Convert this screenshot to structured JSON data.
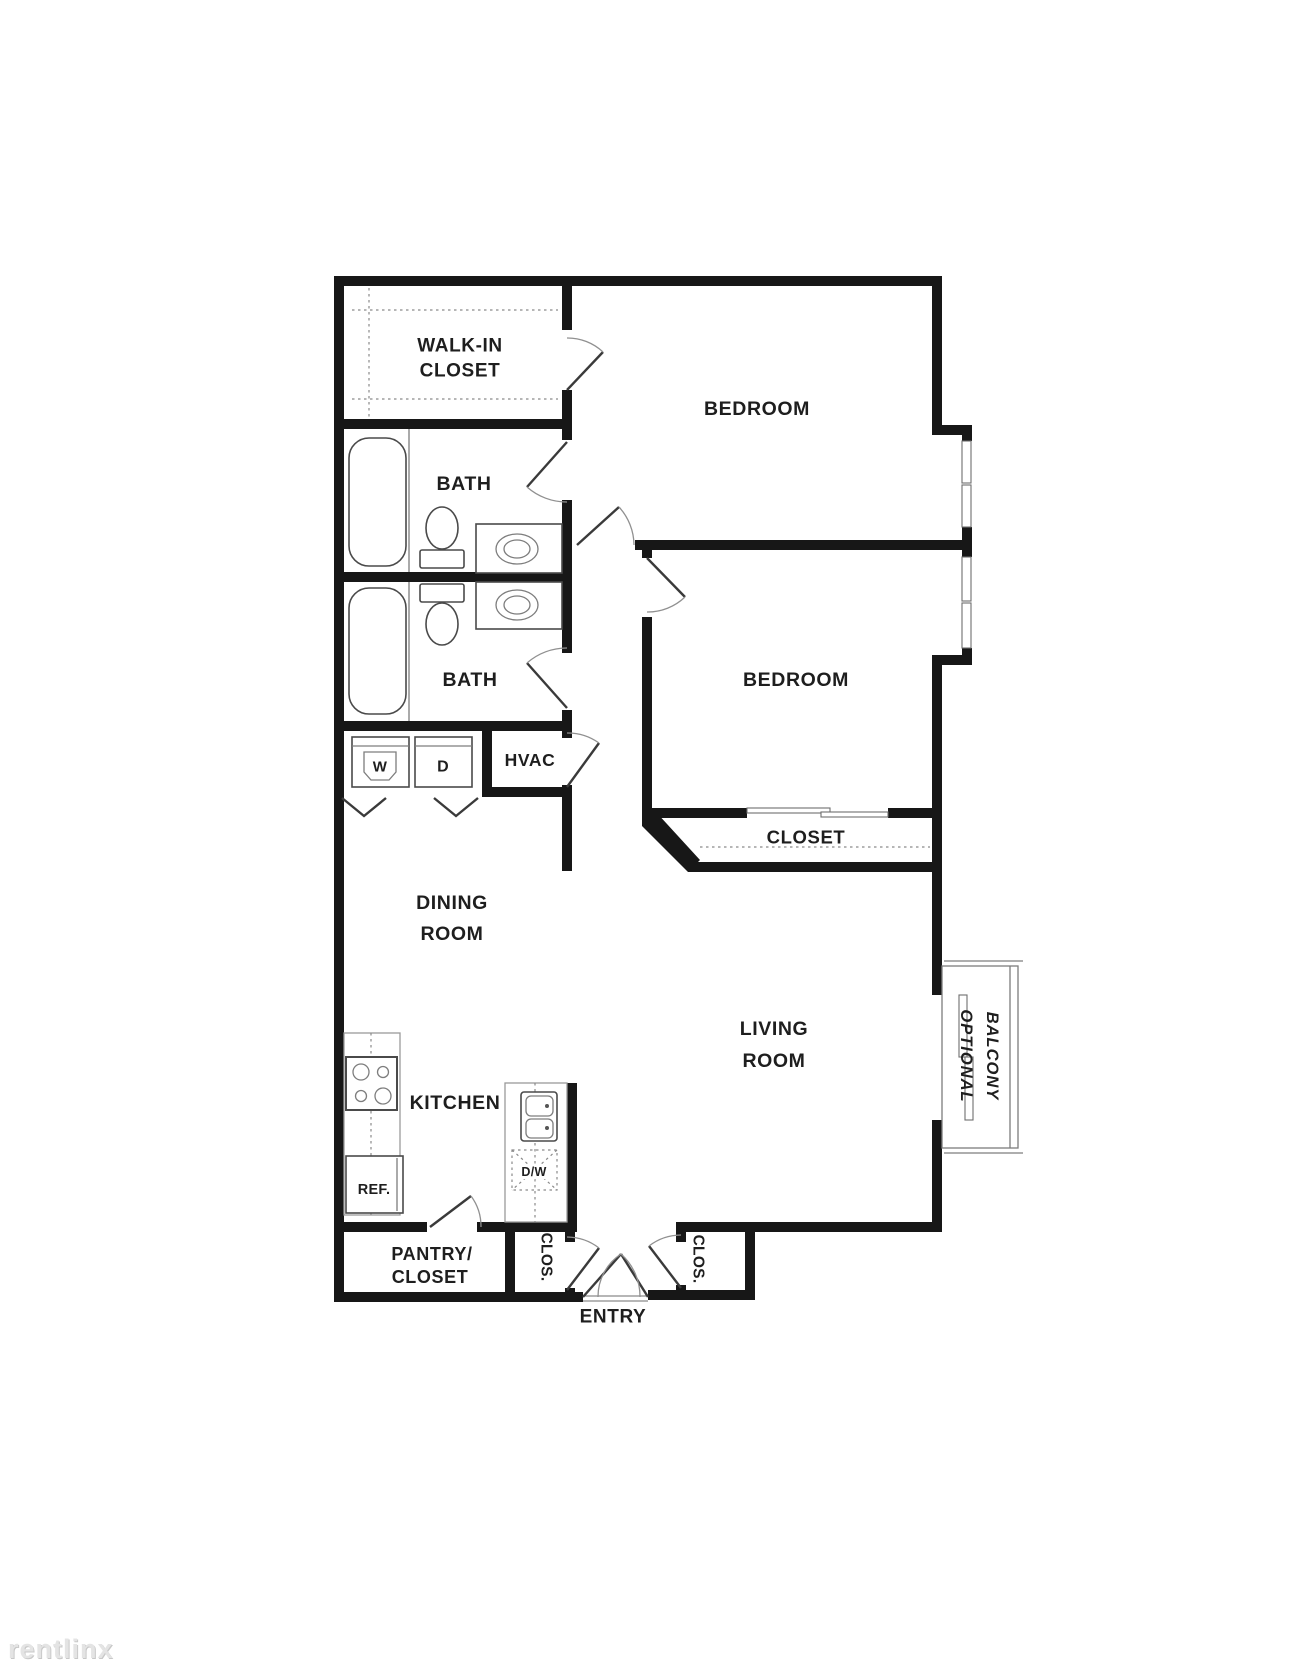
{
  "watermark": "rentlinx",
  "colors": {
    "wall": "#171717",
    "fixture_line": "#4a4a4a",
    "background": "#ffffff"
  },
  "labels": {
    "walk_in_closet_1": "WALK-IN",
    "walk_in_closet_2": "CLOSET",
    "bedroom_1": "BEDROOM",
    "bath_1": "BATH",
    "bath_2": "BATH",
    "bedroom_2": "BEDROOM",
    "hvac": "HVAC",
    "washer": "W",
    "dryer": "D",
    "closet": "CLOSET",
    "dining_1": "DINING",
    "dining_2": "ROOM",
    "living_1": "LIVING",
    "living_2": "ROOM",
    "kitchen": "KITCHEN",
    "ref": "REF.",
    "dw": "D/W",
    "pantry_1": "PANTRY/",
    "pantry_2": "CLOSET",
    "clos_left": "CLOS.",
    "clos_right": "CLOS.",
    "entry": "ENTRY",
    "balcony_1": "OPTIONAL",
    "balcony_2": "BALCONY"
  }
}
